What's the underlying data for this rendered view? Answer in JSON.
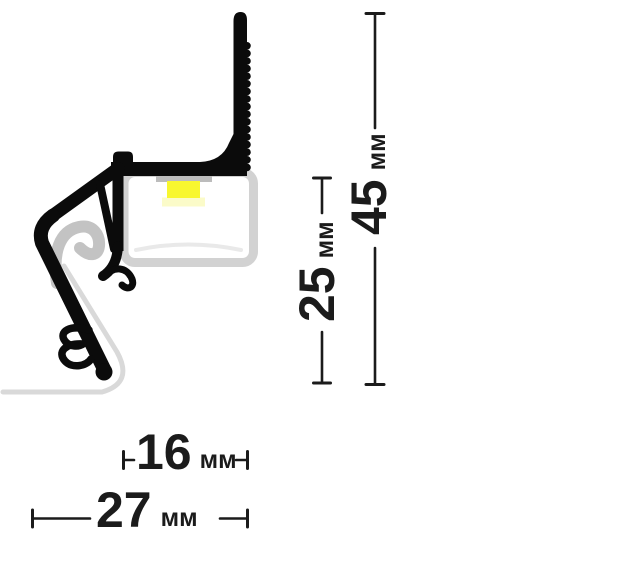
{
  "figure": {
    "subject": "led-profile-cross-section",
    "units_label": "мм",
    "dims": {
      "total_height": {
        "value": "45",
        "unit": "мм"
      },
      "inner_height": {
        "value": "25",
        "unit": "мм"
      },
      "channel_width": {
        "value": "16",
        "unit": "мм"
      },
      "total_width": {
        "value": "27",
        "unit": "мм"
      }
    },
    "colors": {
      "background": "#ffffff",
      "profile": "#0b0b0b",
      "dimension": "#1b1b1b",
      "channel_outline": "#d2d2d2",
      "channel_fill": "#ffffff",
      "diffuser_line": "#e9e9e9",
      "pcb_strip": "#bcbcbc",
      "led": "#f8f72f",
      "led_glow": "#fbfbc9",
      "gasket": "#c3c3c3",
      "membrane": "#d9d9d9"
    }
  }
}
